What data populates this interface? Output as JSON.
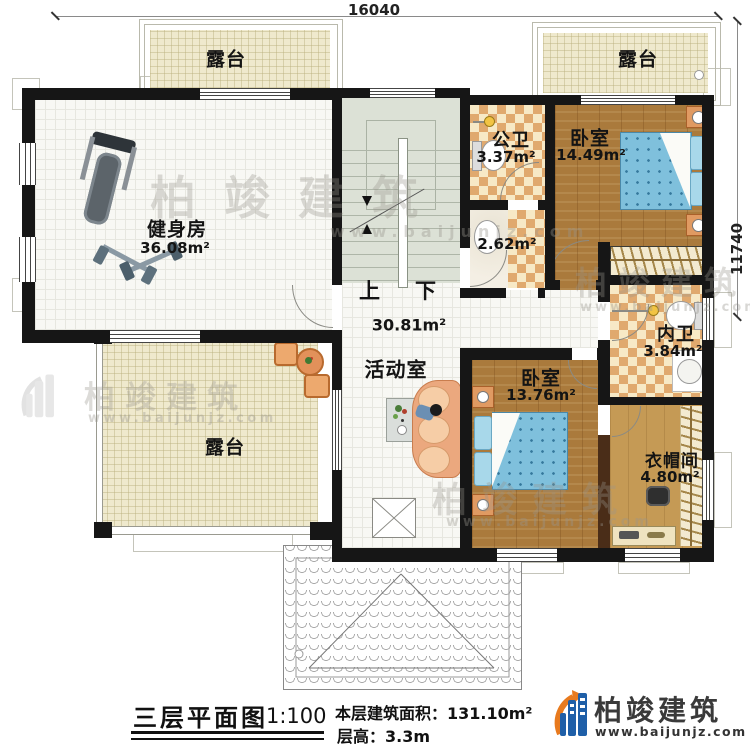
{
  "plan": {
    "dimension_top": "16040",
    "dimension_right": "11740",
    "rooms": {
      "terrace_top_left": {
        "label": "露台"
      },
      "terrace_top_right": {
        "label": "露台"
      },
      "terrace_bottom_left": {
        "label": "露台"
      },
      "gym": {
        "label": "健身房",
        "area": "36.08m²"
      },
      "public_bath": {
        "label": "公卫",
        "area": "3.37m²"
      },
      "washroom": {
        "area": "2.62m²"
      },
      "bedroom_top": {
        "label": "卧室",
        "area": "14.49m²"
      },
      "inner_bath": {
        "label": "内卫",
        "area": "3.84m²"
      },
      "bedroom_middle": {
        "label": "卧室",
        "area": "13.76m²"
      },
      "cloakroom": {
        "label": "衣帽间",
        "area": "4.80m²"
      },
      "activity_room": {
        "label": "活动室",
        "area": "30.81m²"
      }
    },
    "stairs": {
      "up": "上",
      "down": "下"
    }
  },
  "footer": {
    "title": "三层平面图",
    "scale": "1:100",
    "building_area": "本层建筑面积：131.10m²",
    "floor_height": "层高：3.3m"
  },
  "brand": {
    "name": "柏竣建筑",
    "website": "www.baijunjz.com"
  },
  "watermark": {
    "name": "柏竣建筑",
    "website": "www.baijunjz.com"
  }
}
